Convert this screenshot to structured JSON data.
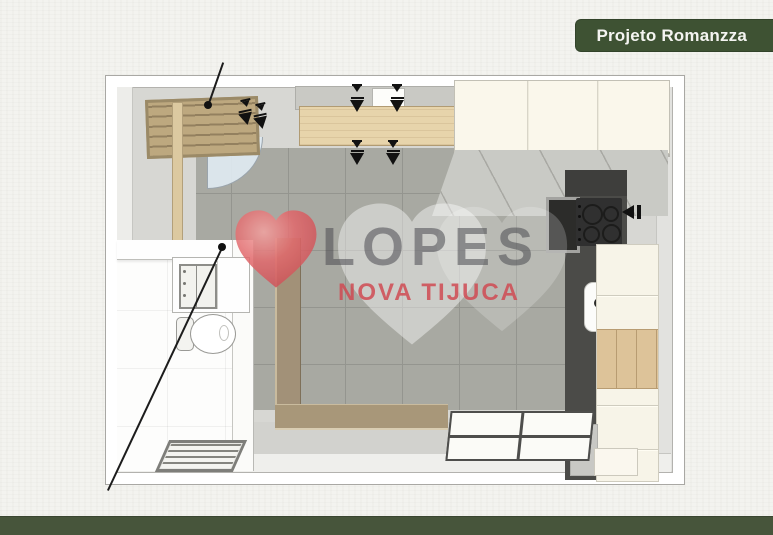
{
  "badge": {
    "label": "Projeto Romanzza"
  },
  "watermark": {
    "brand": "LOPES",
    "subtitle": "NOVA TIJUCA"
  },
  "colors": {
    "badge_green": "#3e5233",
    "footer_green": "#47553b",
    "paper_background": "#f3f3ef",
    "wall_white": "#ffffff",
    "floor_tile_gray": "#a8a9a2",
    "wood_counter": "#e7d4ab",
    "wood_slat_door": "#b7a17c",
    "wood_floor_frame": "#a29178",
    "cabinet_cream": "#f7f4e8",
    "countertop_gray": "#c9cac5",
    "counter_dark": "#4b4b48",
    "cooktop_black": "#303030",
    "door_arc_blue": "#e0ebf3",
    "watermark_text_gray": "rgba(75,75,80,0.55)",
    "watermark_red": "#cf4a52",
    "heart_red": "#e2696c",
    "heart_white": "#ffffff"
  },
  "icons": {
    "heart": "heart shape (svg path)",
    "ceiling_marker": "black bar with solid downward triangle",
    "direction_arrow": "solid left-pointing triangle with bar"
  }
}
